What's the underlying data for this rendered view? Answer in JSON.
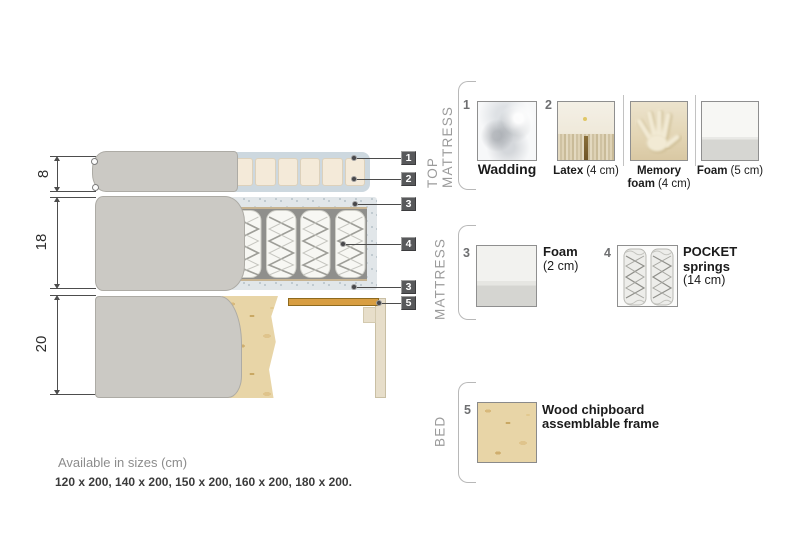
{
  "diagram": {
    "dims": [
      {
        "label": "8"
      },
      {
        "label": "18"
      },
      {
        "label": "20"
      }
    ],
    "callouts": [
      {
        "n": "1"
      },
      {
        "n": "2"
      },
      {
        "n": "3"
      },
      {
        "n": "4"
      },
      {
        "n": "3"
      },
      {
        "n": "5"
      }
    ]
  },
  "legend": {
    "top_mattress": {
      "title": "TOP MATTRESS",
      "item1_num": "1",
      "item1_name": "Wadding",
      "item2_num": "2",
      "item2_name": "Latex",
      "item2_size": "(4 cm)",
      "item3_name1": "Memory",
      "item3_name2": "foam",
      "item3_size": "(4 cm)",
      "item4_name": "Foam",
      "item4_size": "(5 cm)"
    },
    "mattress": {
      "title": "MATTRESS",
      "item1_num": "3",
      "item1_name": "Foam",
      "item1_size": "(2 cm)",
      "item2_num": "4",
      "item2_name1": "POCKET",
      "item2_name2": "springs",
      "item2_size": "(14 cm)"
    },
    "bed": {
      "title": "BED",
      "item1_num": "5",
      "item1_name1": "Wood chipboard",
      "item1_name2": "assemblable frame"
    }
  },
  "footer": {
    "title": "Available in sizes (cm)",
    "sizes": "120 x 200, 140 x 200, 150 x 200, 160 x 200, 180 x 200."
  },
  "colors": {
    "cover_gray": "#cbc9c4",
    "wadding_blue": "#cdd8df",
    "foam_beige": "#f4ead9",
    "wood_slat": "#d89e42",
    "chipboard": "#e8d5a7",
    "callout_bg": "#58595b",
    "section_text": "#9b9b9b"
  }
}
